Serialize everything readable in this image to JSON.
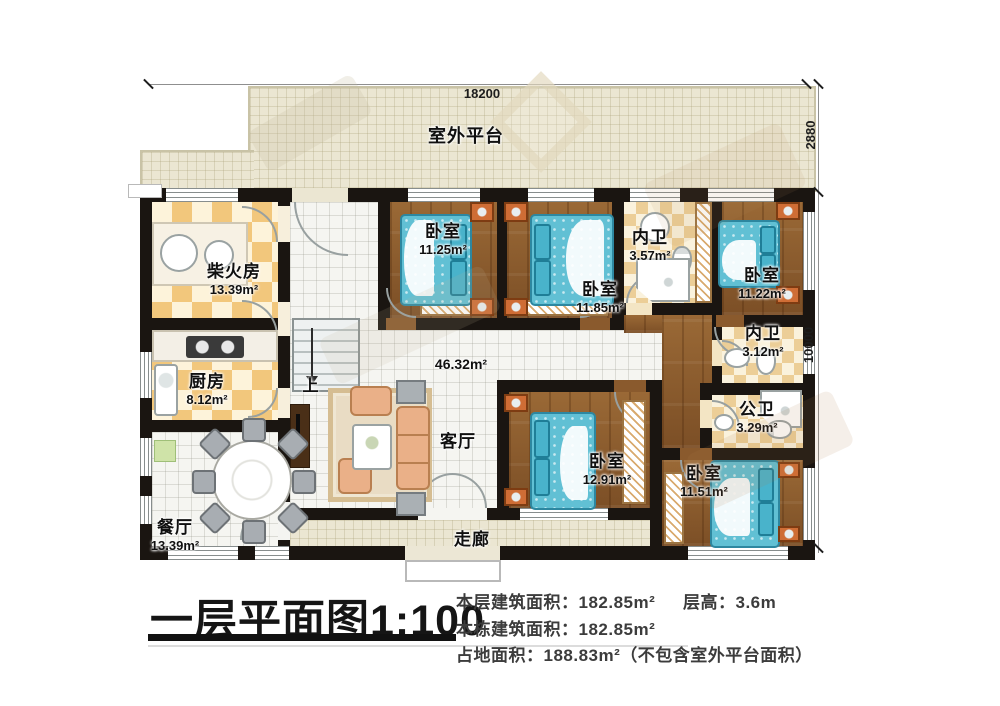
{
  "plan": {
    "outdoor_platform": "室外平台",
    "corridor": "走廊",
    "stairs_up": "上",
    "dimensions": {
      "top": "18200",
      "right_upper": "2880",
      "right_lower": "10000"
    },
    "rooms": [
      {
        "name": "柴火房",
        "area": "13.39m²"
      },
      {
        "name": "厨房",
        "area": "8.12m²"
      },
      {
        "name": "餐厅",
        "area": "13.39m²"
      },
      {
        "name": "客厅",
        "area": "46.32m²"
      },
      {
        "name": "卧室",
        "area": "11.25m²"
      },
      {
        "name": "卧室",
        "area": "11.85m²"
      },
      {
        "name": "内卫",
        "area": "3.57m²"
      },
      {
        "name": "卧室",
        "area": "11.22m²"
      },
      {
        "name": "内卫",
        "area": "3.12m²"
      },
      {
        "name": "公卫",
        "area": "3.29m²"
      },
      {
        "name": "卧室",
        "area": "12.91m²"
      },
      {
        "name": "卧室",
        "area": "11.51m²"
      }
    ]
  },
  "footer": {
    "title": "一层平面图1:100",
    "floor_area": "本层建筑面积：182.85m²",
    "floor_height": "层高：3.6m",
    "building_area": "本栋建筑面积：182.85m²",
    "land_area": "占地面积：188.83m²（不包含室外平台面积）"
  }
}
